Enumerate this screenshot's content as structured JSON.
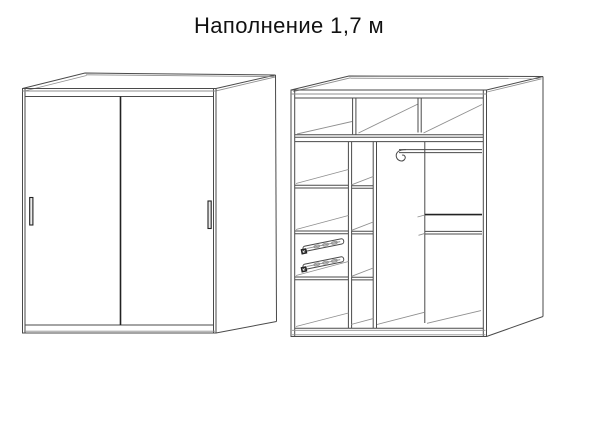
{
  "title": "Наполнение 1,7 м",
  "views": {
    "left": "wardrobe-closed-front-view",
    "right": "wardrobe-open-interior-view"
  },
  "colors": {
    "background": "#ffffff",
    "line": "#4a4a4a",
    "line_light": "#8f8f8f",
    "line_dark": "#222222",
    "text": "#111111"
  }
}
